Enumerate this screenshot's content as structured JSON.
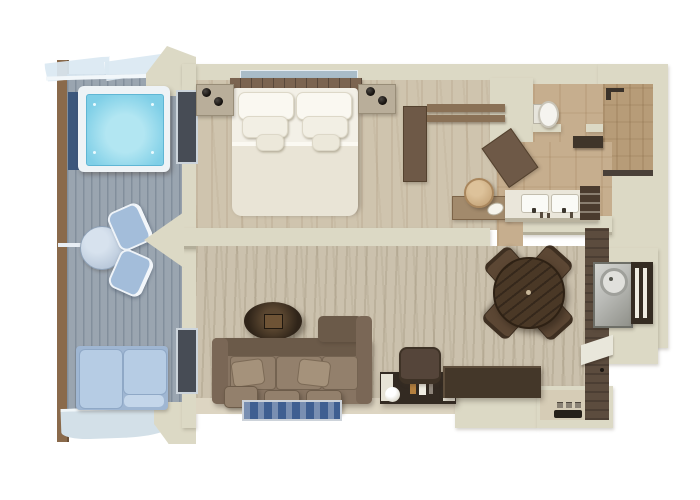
{
  "scene": {
    "description": "3D top-down cutaway rendering of a suite floor plan with private balcony",
    "background": "#ffffff",
    "contains_text": false
  },
  "palette": {
    "wall": "#dcd9c5",
    "wall-shadow": "#b3ae9a",
    "post-brown": "#8a6a4b",
    "deck": "#9aa5b0",
    "canopy": "#dbe9f2",
    "tub-frame": "#eef3f6",
    "tub-water": "#7fcfe7",
    "tub-water-light": "#b2e6f2",
    "navy-panel": "#3c577c",
    "glass-dark": "#474c55",
    "glass-frame": "#ccd4db",
    "wood-floor": "#cfc4ae",
    "bath-floor": "#c6ae8e",
    "tile": "#b79c78",
    "carpet": "#cbc1ad",
    "floor-strip": "#ddd5c2",
    "entry-floor": "#d6ccb6",
    "bed-sheet": "#f3f0e7",
    "bed-fold": "#e9e4d6",
    "pillow-white": "#faf8f1",
    "headboard": "#7b6450",
    "nightstand": "#b9ae9a",
    "lamp-black": "#15110e",
    "ledge-glass": "#a9bcc8",
    "wardrobe": "#6e5947",
    "rail-wood": "#8a7156",
    "dresser": "#a28a6c",
    "stool-tan": "#c9a97e",
    "toilet-white": "#f5f4ef",
    "vanity-top": "#eae6da",
    "sink-white": "#fafaf6",
    "shelf-dark": "#4a3b2e",
    "sofa": "#877462",
    "sofa-dark": "#6b5a49",
    "sofa-arm": "#7a6756",
    "sofa-cushion": "#93806c",
    "sofa-pillow": "#a5927b",
    "oval-table": "#2f2419",
    "rug-blue": "#3f5f91",
    "rug-border": "#cdd3da",
    "dining-table": "#4a3826",
    "dining-chair": "#5c4734",
    "desk-dark": "#332a22",
    "desk-chair": "#55453a",
    "credenza": "#443729",
    "feature-wall": "#5c4c3e",
    "metal": "#b9bab6",
    "slat-panel": "#352c22",
    "threshold": "#262019",
    "book-amber": "#b5803f",
    "daybed-cushion": "#b6cce4",
    "daybed-base": "#9fb6d2",
    "balcony-table-top": "#b9c8da",
    "balcony-chair": "#a3bdda",
    "deck-edge": "#d3e0e8"
  },
  "rooms": [
    {
      "name": "balcony",
      "features": [
        "glass-canopy",
        "hot-tub",
        "windbreak-panel",
        "bistro-table",
        "two-chairs",
        "daybed",
        "deck-edge"
      ]
    },
    {
      "name": "bedroom",
      "features": [
        "double-bed",
        "headboard",
        "glass-ledge",
        "nightstand-left",
        "nightstand-right",
        "sphere-lamps",
        "window-wall"
      ]
    },
    {
      "name": "walk-in-closet",
      "features": [
        "wardrobe",
        "clothes-rails",
        "angled-wardrobe",
        "dresser",
        "round-stool",
        "dish"
      ]
    },
    {
      "name": "bathroom",
      "features": [
        "toilet-room",
        "toilet",
        "walk-in-shower",
        "shower-head",
        "bench",
        "double-vanity",
        "two-sinks",
        "amenity-shelf"
      ]
    },
    {
      "name": "living-room",
      "features": [
        "l-shaped-sofa",
        "seat-cushions",
        "throw-pillows",
        "ottomans",
        "oval-coffee-table",
        "blue-rug",
        "desk",
        "desk-chair",
        "desk-lamp",
        "books",
        "credenza"
      ]
    },
    {
      "name": "dining-area",
      "features": [
        "round-dining-table",
        "four-dining-chairs"
      ]
    },
    {
      "name": "entry",
      "features": [
        "wet-bar-sink",
        "slat-panel",
        "dark-feature-wall",
        "wall-stripe",
        "door-threshold",
        "floor-tiles"
      ]
    }
  ]
}
